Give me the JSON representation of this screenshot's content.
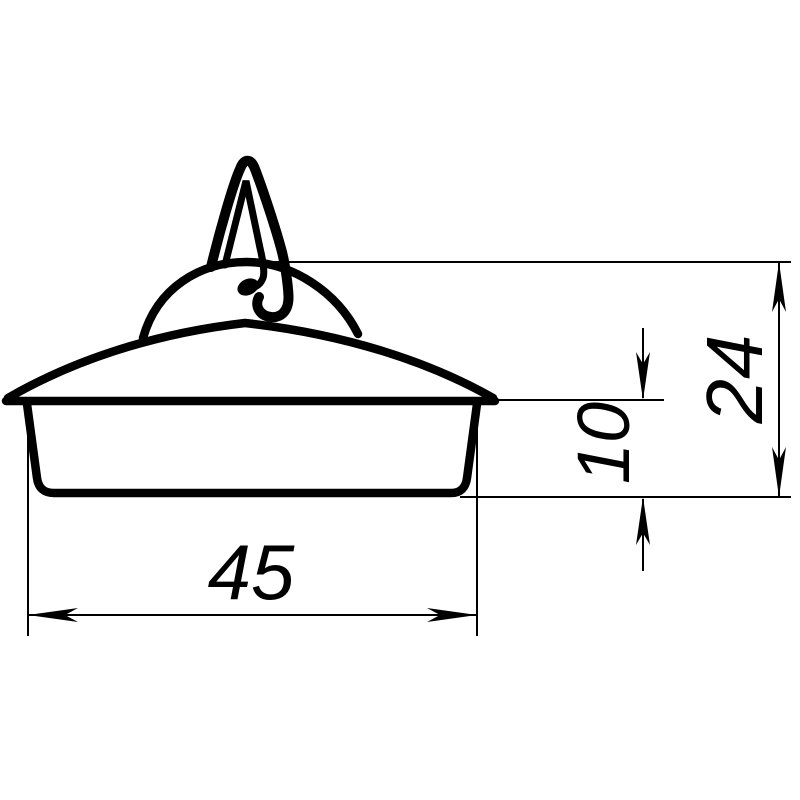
{
  "drawing": {
    "kind": "technical-drawing",
    "background_color": "#ffffff",
    "line_color": "#000000",
    "dimension_labels": {
      "width": "45",
      "cup_height": "10",
      "overall_height": "24"
    }
  }
}
